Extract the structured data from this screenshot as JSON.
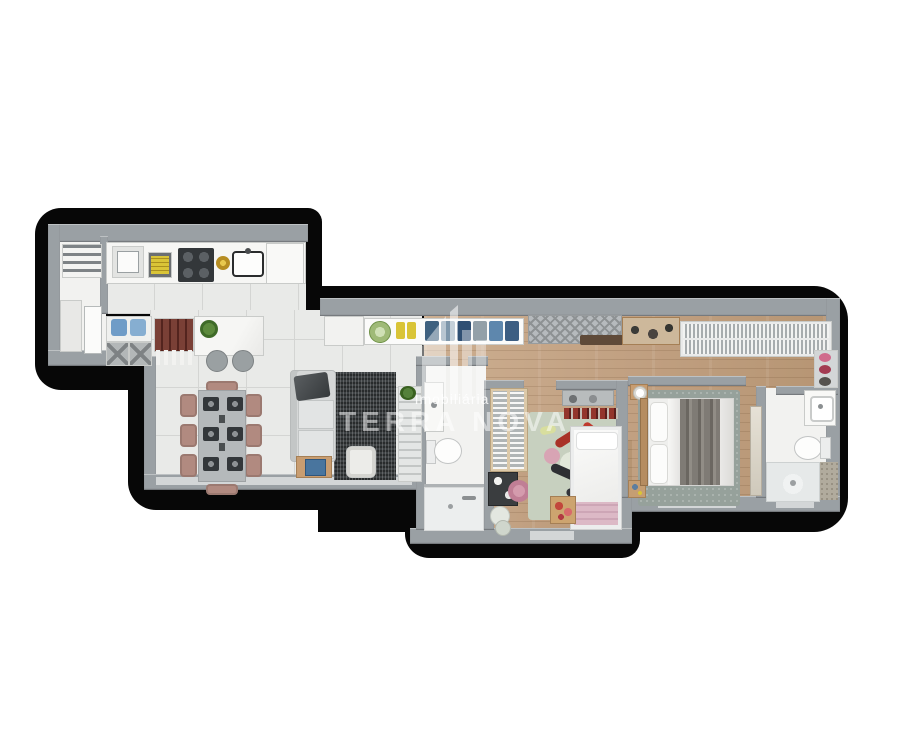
{
  "watermark": {
    "line1": "Imobiliária",
    "line2": "TERRA NOVA"
  },
  "palette": {
    "outline": "#070707",
    "wall": "#9aa0a4",
    "wall-light": "#d3d6d7",
    "tile": "#e9eae8",
    "tile-line": "#d4d5d3",
    "white-floor": "#f2f2f0",
    "counter": "#f6f6f4",
    "wood-furniture": "#c89d71",
    "sofa": "#d6d8d8",
    "rug-dark": "#3e4244",
    "rug-master": "#96a19b",
    "rug-kids": "#c7d0bf",
    "chair-rose": "#b18a80",
    "stove": "#33373a",
    "accent-blue": "#6f9cc7",
    "accent-yellow": "#d9c437",
    "accent-green": "#6f9247",
    "accent-pink": "#c07e95",
    "accent-red": "#a93328",
    "bar-wine": "#7a4036",
    "blanket-gray": "#7f7b75",
    "blanket-pink": "#dcb9c6",
    "watermark": "rgba(255,255,255,0.6)"
  }
}
